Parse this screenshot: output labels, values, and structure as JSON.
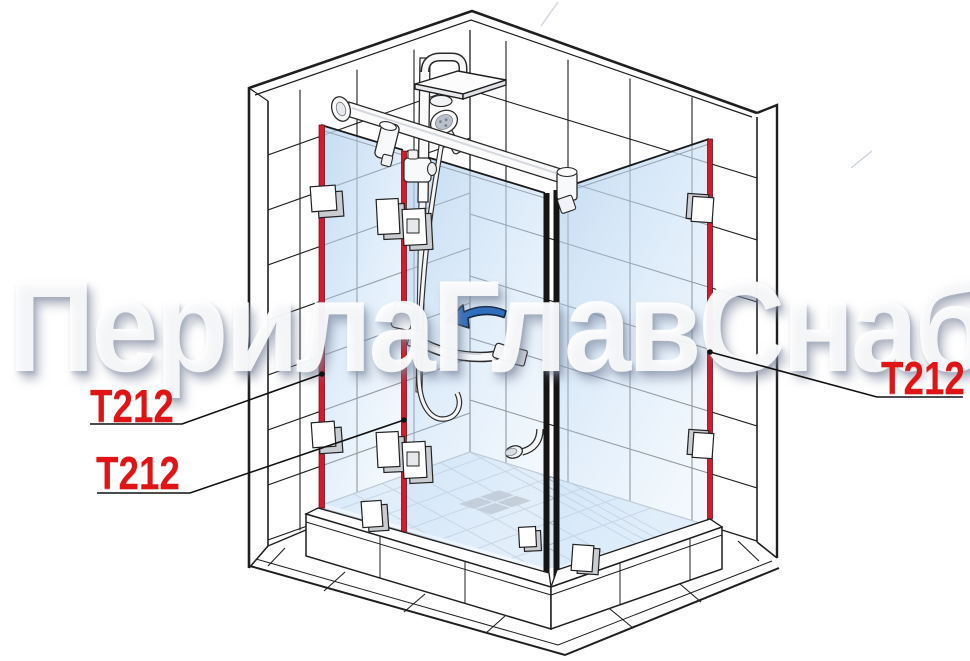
{
  "diagram": {
    "type": "technical-illustration",
    "subject": "corner shower enclosure with hinged glass door, tiled walls and shower set",
    "watermark": {
      "text": "ПерилаГлавСнаб"
    },
    "labels": [
      {
        "id": "hinge-label-left-upper",
        "text": "T212"
      },
      {
        "id": "hinge-label-left-lower",
        "text": "T212"
      },
      {
        "id": "hinge-label-right",
        "text": "T212"
      }
    ],
    "colors": {
      "label_red": "#e01414",
      "hinge_profile_red": "#d8192b",
      "door_edge_black": "#151515",
      "swing_arrow_blue": "#2e6fc0",
      "glass_tint": "#cfe3f7",
      "line_black": "#1f1f1f",
      "watermark_white": "#ffffff"
    }
  }
}
